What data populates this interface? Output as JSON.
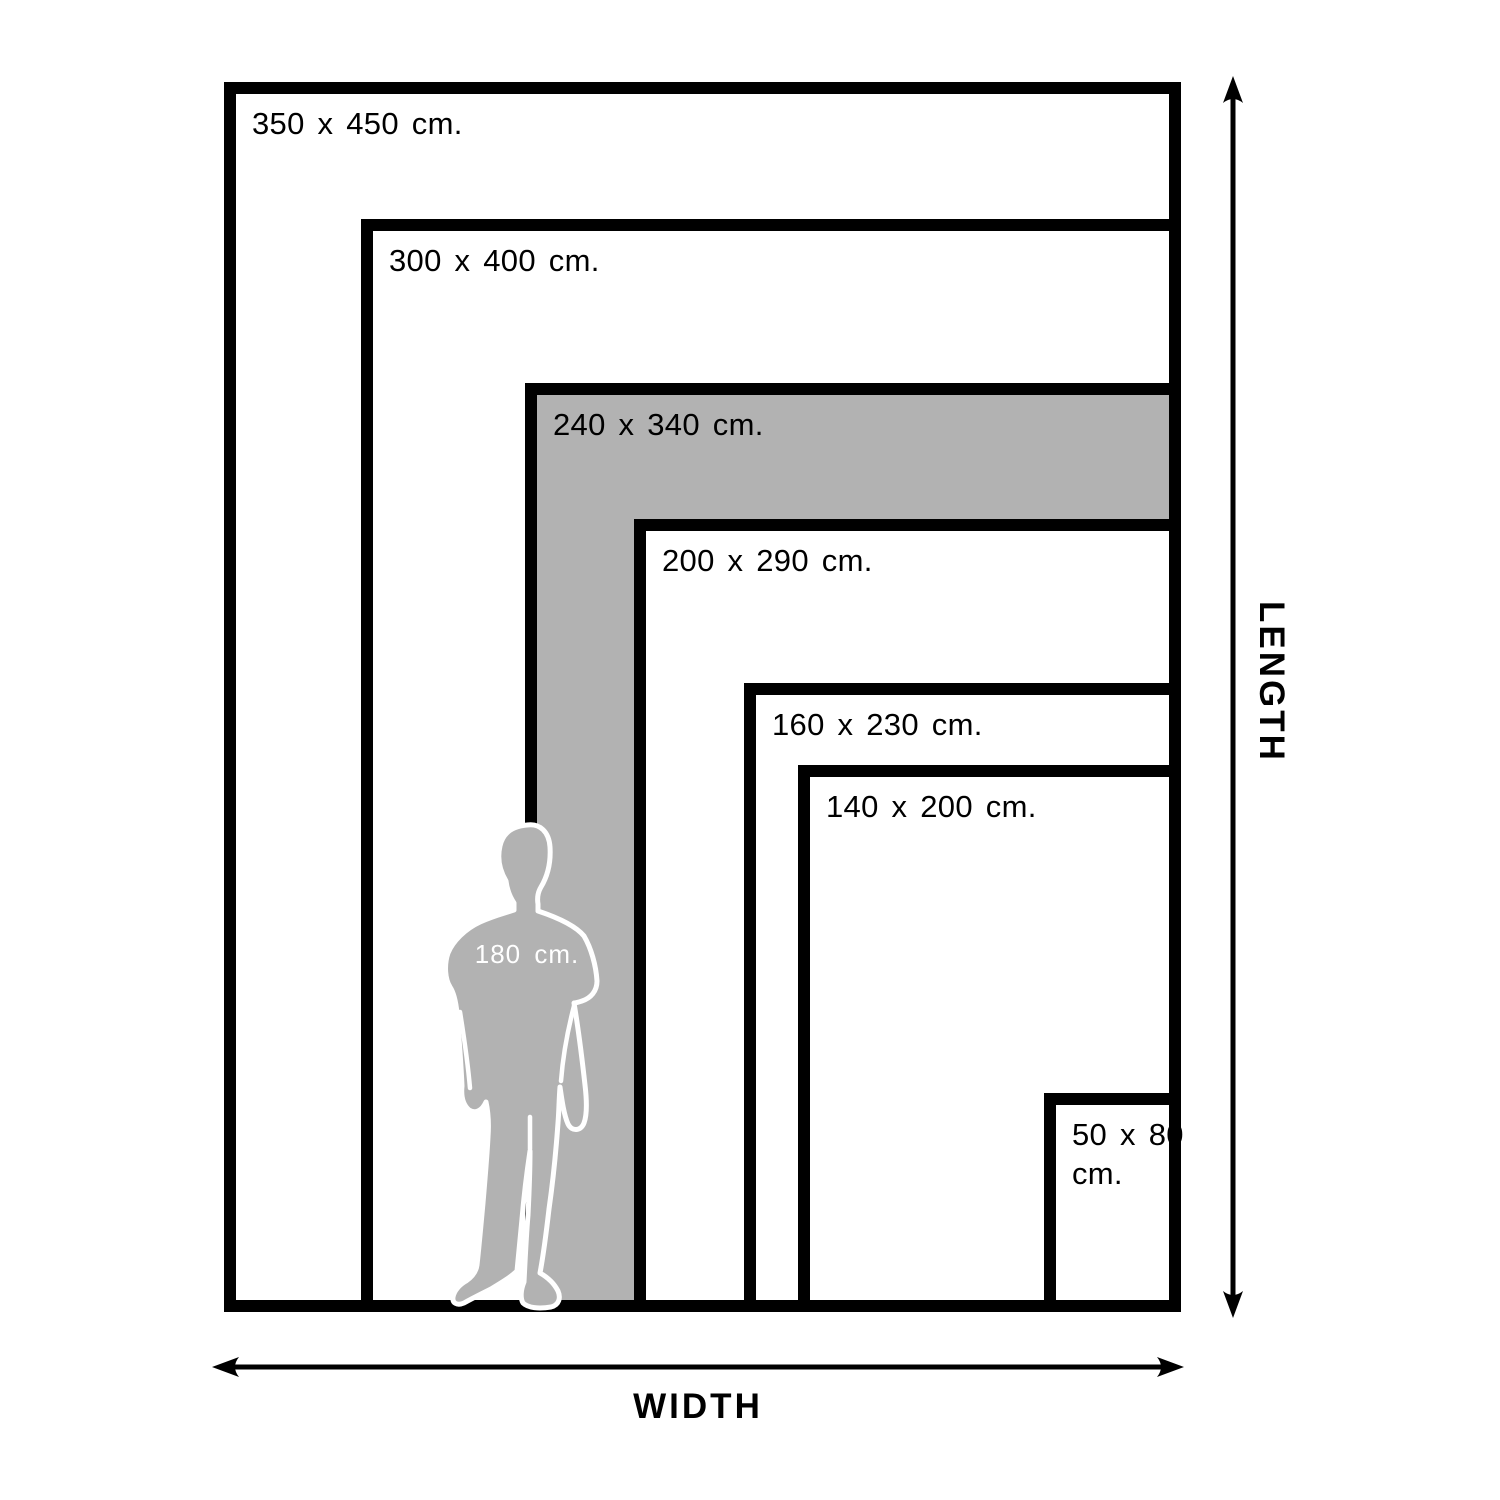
{
  "diagram": {
    "colors": {
      "line": "#000000",
      "highlight": "#b2b2b2",
      "background": "#ffffff",
      "person_fill": "#b2b2b2",
      "person_outline": "#ffffff",
      "person_label": "#ffffff"
    },
    "sizes": [
      {
        "label": "350 x 450 cm.",
        "width_cm": 350,
        "length_cm": 450,
        "highlighted": false
      },
      {
        "label": "300 x 400 cm.",
        "width_cm": 300,
        "length_cm": 400,
        "highlighted": false
      },
      {
        "label": "240 x 340 cm.",
        "width_cm": 240,
        "length_cm": 340,
        "highlighted": true
      },
      {
        "label": "200 x 290 cm.",
        "width_cm": 200,
        "length_cm": 290,
        "highlighted": false
      },
      {
        "label": "160 x 230 cm.",
        "width_cm": 160,
        "length_cm": 230,
        "highlighted": false
      },
      {
        "label": "140 x 200 cm.",
        "width_cm": 140,
        "length_cm": 200,
        "highlighted": false
      },
      {
        "label": "50 x 80\ncm.",
        "width_cm": 50,
        "length_cm": 80,
        "highlighted": false
      }
    ],
    "person": {
      "label": "180 cm.",
      "height_cm": 180
    },
    "axis": {
      "width_label": "WIDTH",
      "length_label": "LENGTH"
    }
  }
}
